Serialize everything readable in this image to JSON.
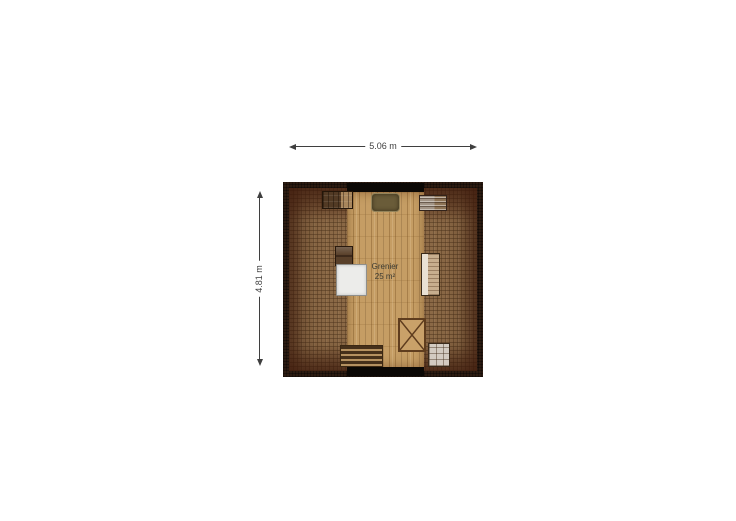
{
  "floorplan": {
    "room": {
      "name": "Grenier",
      "area": "25 m²"
    },
    "dimensions": {
      "width_label": "5.06 m",
      "height_label": "4.81 m"
    },
    "colors": {
      "wall": "#0b0805",
      "roof_border": "#2c1b11",
      "carpet": "#8b6946",
      "wood": "#c59d64",
      "dim_line": "#3f3f3f",
      "label_text": "#3a3a32"
    },
    "furniture": [
      {
        "name": "dresser-top-left"
      },
      {
        "name": "storage-bench-top"
      },
      {
        "name": "dresser-top-right"
      },
      {
        "name": "cabinet-left"
      },
      {
        "name": "white-table"
      },
      {
        "name": "shelf-sofa-right"
      },
      {
        "name": "floor-hatch"
      },
      {
        "name": "stairs"
      },
      {
        "name": "cabinet-bottom-right"
      }
    ]
  }
}
